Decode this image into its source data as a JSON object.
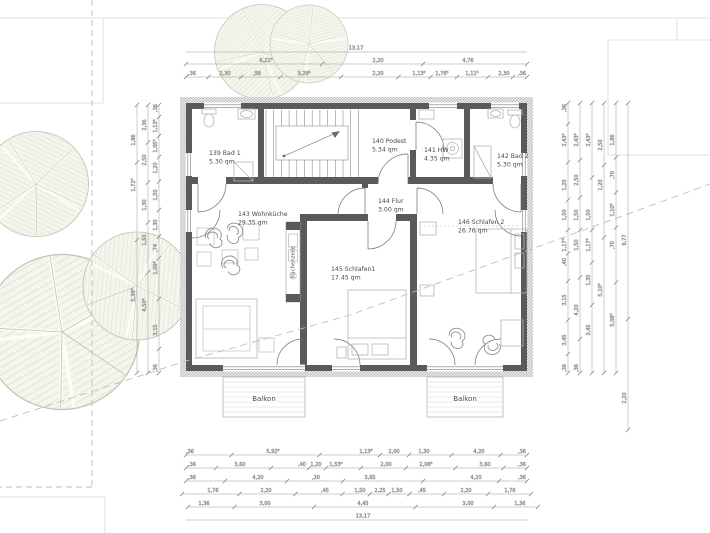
{
  "drawing": {
    "type": "floor-plan",
    "language": "de"
  },
  "rooms": {
    "bad1": {
      "name": "139 Bad 1",
      "area": "5.30 qm"
    },
    "podest": {
      "name": "140 Podest",
      "area": "5.34 qm"
    },
    "hw": {
      "name": "141 HW",
      "area": "4.35 qm"
    },
    "bad2": {
      "name": "142 Bad 2",
      "area": "5.30 qm"
    },
    "wohnkueche": {
      "name": "143 Wohnküche",
      "area": "29.35 qm"
    },
    "flur": {
      "name": "144 Flur",
      "area": "3.00 qm"
    },
    "schlafen1": {
      "name": "145 Schlafen1",
      "area": "17.45 qm"
    },
    "schlafen2": {
      "name": "146 Schlafen 2",
      "area": "26.76 qm"
    }
  },
  "labels": {
    "balkon1": "Balkon",
    "balkon2": "Balkon",
    "kuechenzeile": "Küchenzeile"
  },
  "dimensions": {
    "top_overall": "13,17",
    "bottom_overall": "13,17",
    "top_row1": [
      "6,21⁵",
      "2,20",
      "4,76"
    ],
    "top_row2": [
      ",36",
      "2,30",
      ",99",
      "3,28⁵",
      "2,20",
      "1,13⁵",
      "1,76⁵",
      "1,11⁵",
      "2,30",
      ",36"
    ],
    "bottom_row1": [
      ",36",
      "5,92⁵",
      "1,13⁵",
      "2,00",
      "1,30",
      "4,20",
      ",36"
    ],
    "bottom_row2": [
      ",36",
      "3,60",
      ",40",
      "1,20",
      "1,53⁵",
      "2,00",
      "2,06⁵",
      "3,60",
      ",36"
    ],
    "bottom_row3": [
      ",36",
      "4,20",
      ",20",
      "3,65",
      "4,20",
      ",36"
    ],
    "bottom_row4": [
      "1,76",
      "2,20",
      ",45",
      "1,50",
      "2,25",
      "1,50",
      ",45",
      "2,20",
      "1,76"
    ],
    "bottom_row5": [
      "1,36",
      "3,00",
      "4,45",
      "3,00",
      "1,36"
    ],
    "left_a": [
      "1,86",
      "1,72⁵",
      "5,38⁵"
    ],
    "left_b": [
      "2,36",
      "2,50",
      "1,30",
      "1,50",
      "4,50⁵"
    ],
    "left_c": [
      ",36",
      "1,13⁵",
      "1,05⁵",
      "1,20",
      "1,50",
      "1,30",
      ",74",
      "1,09⁵",
      "3,15",
      ",36"
    ],
    "right_a": [
      ",36",
      "2,43⁵",
      "1,20",
      "1,50",
      "1,17⁵",
      ",40",
      "3,15",
      "3,45",
      ",36"
    ],
    "right_b": [
      "2,43⁵",
      "2,50",
      "1,50",
      "1,50",
      "4,20",
      ",36"
    ],
    "right_c": [
      "2,43⁵",
      "1,50",
      "1,17⁵",
      "1,35",
      "3,45"
    ],
    "right_d": [
      "2,50",
      "1,20",
      "5,10⁵"
    ],
    "right_e": [
      "1,86",
      ",70",
      "1,10⁵",
      ",70",
      "5,08⁵"
    ],
    "right_f": [
      "9,77",
      "2,20"
    ]
  },
  "colors": {
    "wall": "#5a5a5a",
    "hatch_dot": "#9a9a9a",
    "dim_line": "#9a9a9a",
    "furniture": "#b5b5b5",
    "tree_stroke": "#bdbcab",
    "tree_hatch": "#d7d6c6",
    "dashed_boundary": "#bdbdbd",
    "neighbor_faint": "#d8d8d8"
  }
}
